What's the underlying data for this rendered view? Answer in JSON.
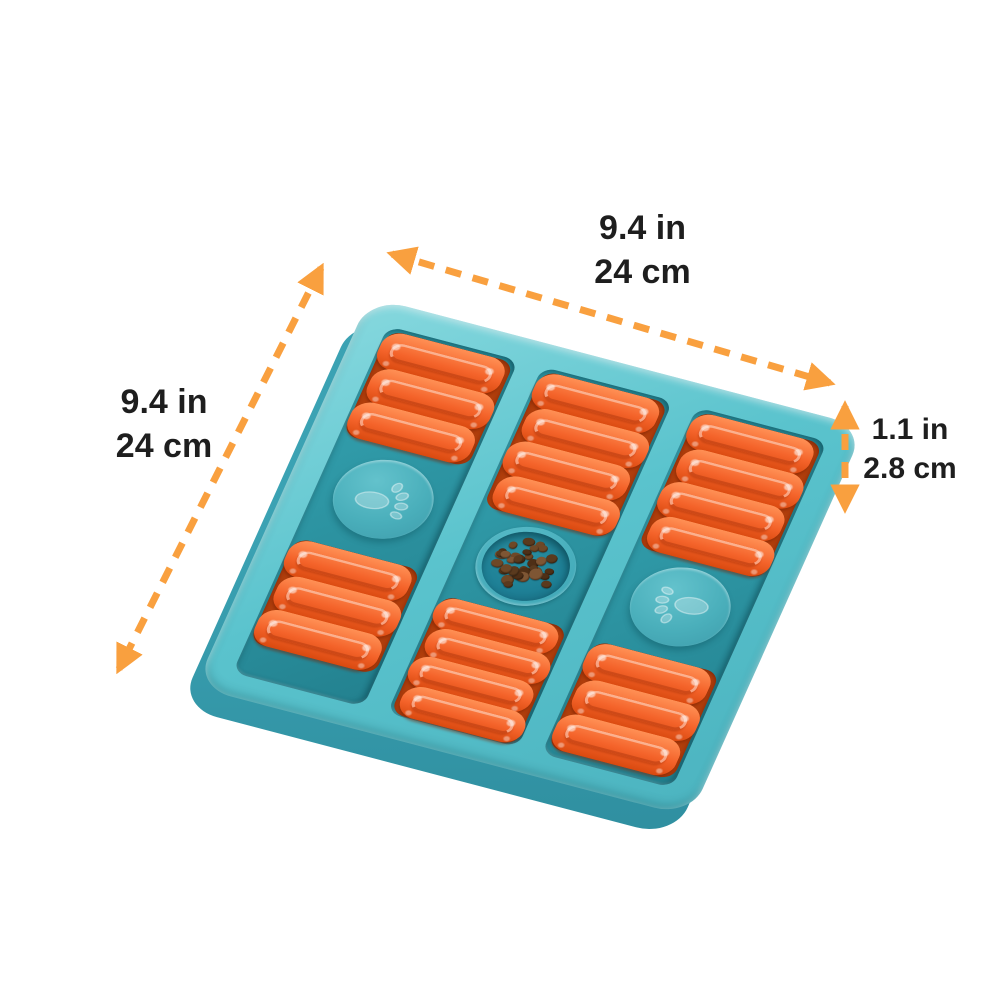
{
  "product": {
    "name": "dog puzzle slow feeder board",
    "kibble_count": 34,
    "columns": [
      {
        "top_sliders": 3,
        "center": "paw-button",
        "bottom_sliders": 3
      },
      {
        "top_sliders": 4,
        "center": "food-well",
        "bottom_sliders": 4
      },
      {
        "top_sliders": 4,
        "center": "paw-button",
        "bottom_sliders": 3
      }
    ]
  },
  "dimensions": {
    "width": {
      "inches": "9.4 in",
      "cm": "24 cm"
    },
    "height": {
      "inches": "9.4 in",
      "cm": "24 cm"
    },
    "depth": {
      "inches": "1.1 in",
      "cm": "2.8 cm"
    }
  },
  "colors": {
    "board_frame": "#5ac3cd",
    "board_side": "#3ba2b3",
    "channel_floor": "#35a4b2",
    "slider_orange": "#f4632a",
    "paw_button": "#4aafbb",
    "well_teal": "#1e8096",
    "kibble_brown": "#6e4827",
    "arrow_orange": "#f9a03f",
    "label_text": "#1e1e1e",
    "background": "#ffffff"
  }
}
